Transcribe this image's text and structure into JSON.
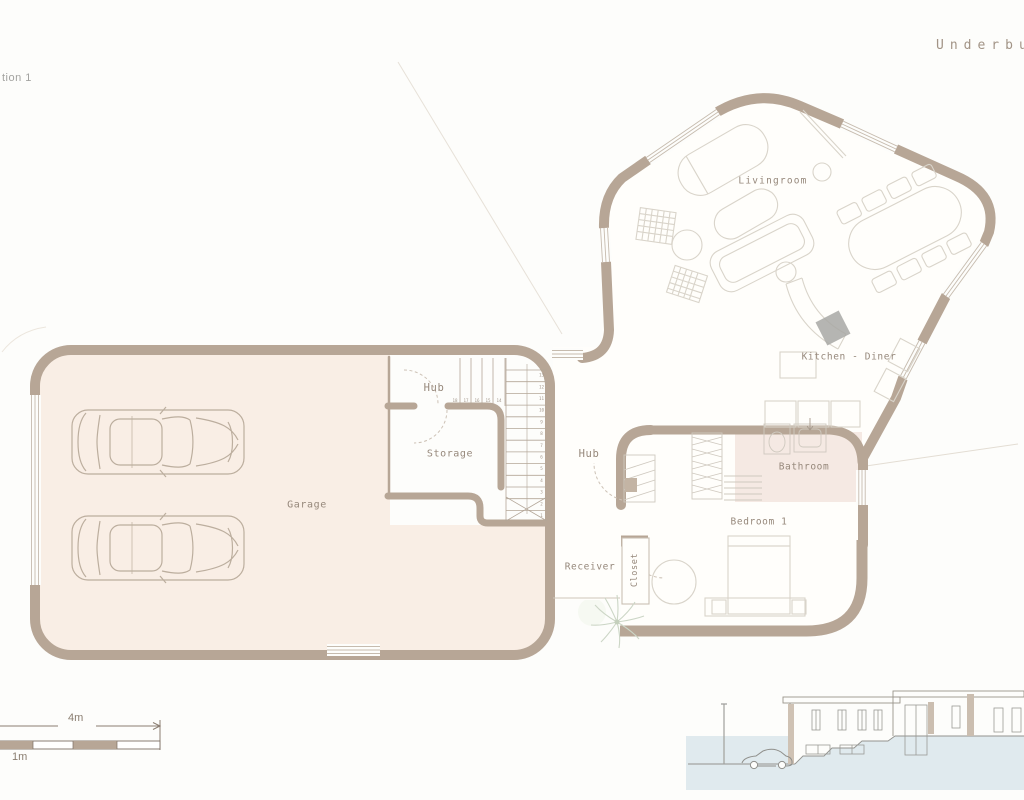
{
  "page": {
    "left_caption": "tion 1",
    "right_title": "Underbui"
  },
  "plan": {
    "rooms": [
      {
        "key": "livingroom",
        "label": "Livingroom"
      },
      {
        "key": "kitchen_diner",
        "label": "Kitchen - Diner"
      },
      {
        "key": "hub_upper",
        "label": "Hub"
      },
      {
        "key": "storage",
        "label": "Storage"
      },
      {
        "key": "garage",
        "label": "Garage"
      },
      {
        "key": "hub_lower",
        "label": "Hub"
      },
      {
        "key": "bathroom",
        "label": "Bathroom"
      },
      {
        "key": "bedroom_1",
        "label": "Bedroom 1"
      },
      {
        "key": "receiver",
        "label": "Receiver"
      },
      {
        "key": "closet",
        "label": "Closet"
      }
    ],
    "stairs": {
      "tread_numbers": [
        1,
        2,
        3,
        4,
        5,
        6,
        7,
        8,
        9,
        10,
        11,
        12,
        13,
        14,
        15,
        16,
        17,
        18
      ]
    }
  },
  "scale_bar": {
    "length_label": "4m",
    "unit_label": "1m"
  },
  "colors": {
    "wall": "#b7a696",
    "garage_floor": "#f9eee5",
    "bathroom_floor": "#f5e9e3",
    "section_band": "#e0eaee",
    "label_text": "#96887b"
  }
}
